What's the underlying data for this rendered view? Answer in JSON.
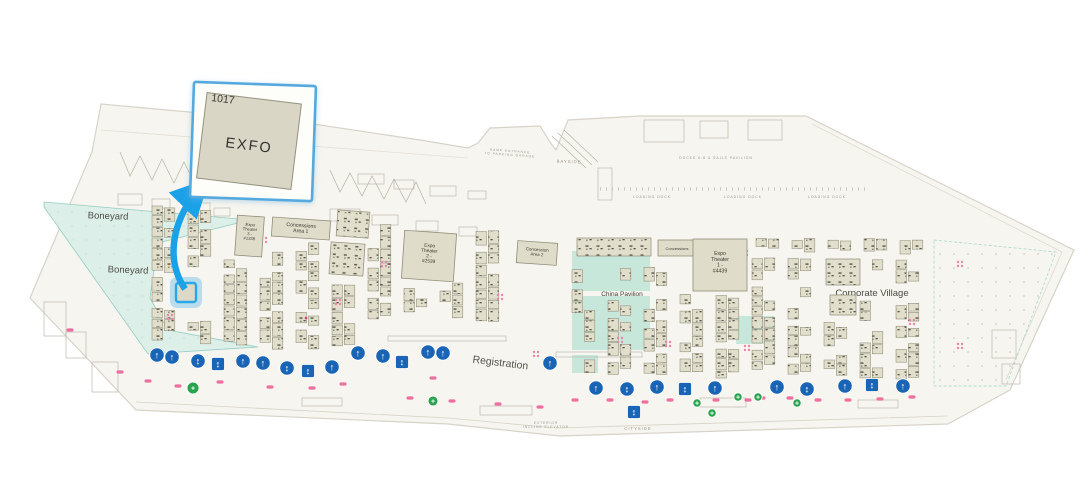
{
  "callout": {
    "booth_number": "1017",
    "exhibitor_name": "EXFO"
  },
  "map": {
    "areas": {
      "boneyard_upper": "Boneyard",
      "boneyard_lower": "Boneyard",
      "expo_theater_3": "Expo\nTheater\n3 -\n#1339",
      "concessions_area_1": "Concessions\nArea 1",
      "expo_theater_2": "Expo\nTheater\n2 -\n#2539",
      "concession_area_2": "Concession\nArea 2",
      "concessions": "Concessions",
      "expo_theater_1": "Expo\nTheater\n1 -\n#4439",
      "china_pavilion": "China Pavilion",
      "corporate_village": "Corporate Village",
      "registration": "Registration"
    },
    "small_labels": {
      "bayside": "BAYSIDE",
      "cityside": "CITYSIDE",
      "loading_dock": "LOADING DOCK",
      "ramp_entrance": "RAMP ENTRANCE\nTO PARKING GARAGE",
      "docks_pavilion": "DOCKS 6-8 & SAILS PAVILION",
      "incline_elevator": "EXTERIOR\nINCLINE ELEVATOR"
    },
    "icons": {
      "escalator_up": "↑",
      "escalator_swap": "↕",
      "elevator": "↕",
      "accessible": "+"
    },
    "colors": {
      "building_fill": "#f7f5ef",
      "building_stroke": "#d6d3c8",
      "booth_fill": "#e1decb",
      "booth_stroke": "#8f8c77",
      "teal_zone": "#dcefe9",
      "china_teal": "#c8e7db",
      "icon_blue": "#1a64b6",
      "accessible_green": "#2aa34f",
      "marker_pink": "#ee6f9f",
      "arrow_blue": "#1ba1e8",
      "callout_border": "#55a9de"
    }
  }
}
